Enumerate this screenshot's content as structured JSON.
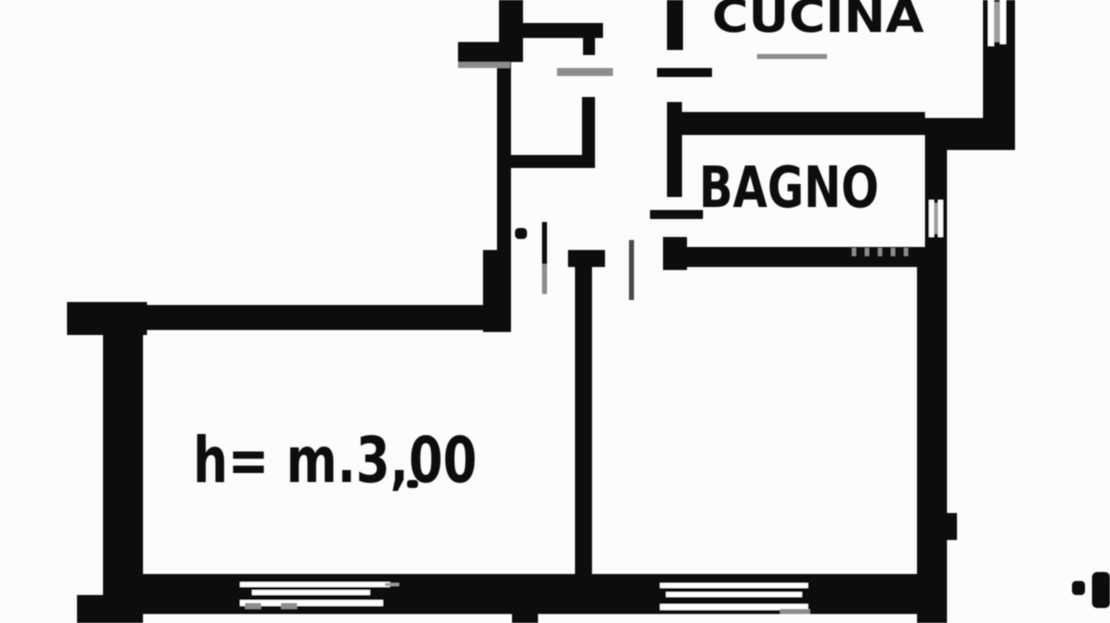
{
  "document": {
    "kind": "scanned-floor-plan",
    "paper": "#fcfcfc",
    "ink": "#0c0c0c",
    "faint": "#8c8c8c",
    "mullion": "#9c9c9c",
    "white": "#ffffff"
  },
  "labels": {
    "kitchen": "CUCINA",
    "bathroom": "BAGNO",
    "ceiling_height": "h= m.3,00"
  },
  "plan": {
    "width": 1110,
    "height": 623,
    "walls": [
      {
        "name": "hall-wall-upper",
        "x": 499,
        "y": 0,
        "w": 24,
        "h": 62
      },
      {
        "name": "hall-wall-tab",
        "x": 458,
        "y": 42,
        "w": 42,
        "h": 20
      },
      {
        "name": "hall-wall-mid",
        "x": 497,
        "y": 62,
        "w": 14,
        "h": 192
      },
      {
        "name": "hall-wall-base",
        "x": 483,
        "y": 250,
        "w": 28,
        "h": 82
      },
      {
        "name": "living-top-wall",
        "x": 67,
        "y": 305,
        "w": 430,
        "h": 25
      },
      {
        "name": "living-top-left-corner",
        "x": 67,
        "y": 302,
        "w": 80,
        "h": 33
      },
      {
        "name": "living-left-wall",
        "x": 103,
        "y": 330,
        "w": 40,
        "h": 293
      },
      {
        "name": "living-left-foot",
        "x": 77,
        "y": 595,
        "w": 66,
        "h": 28
      },
      {
        "name": "bottom-wall",
        "x": 143,
        "y": 574,
        "w": 790,
        "h": 40
      },
      {
        "name": "bottom-wall-nub",
        "x": 512,
        "y": 610,
        "w": 26,
        "h": 13
      },
      {
        "name": "partition-wall",
        "x": 575,
        "y": 252,
        "w": 17,
        "h": 330
      },
      {
        "name": "partition-cap",
        "x": 568,
        "y": 250,
        "w": 37,
        "h": 17
      },
      {
        "name": "right-wall",
        "x": 917,
        "y": 247,
        "w": 30,
        "h": 376
      },
      {
        "name": "right-wall-bump",
        "x": 947,
        "y": 513,
        "w": 10,
        "h": 27
      },
      {
        "name": "bath-right-wall",
        "x": 925,
        "y": 148,
        "w": 22,
        "h": 99
      },
      {
        "name": "setback-wall",
        "x": 925,
        "y": 118,
        "w": 90,
        "h": 32
      },
      {
        "name": "kitchen-right-wall",
        "x": 983,
        "y": 0,
        "w": 32,
        "h": 148
      },
      {
        "name": "bath-top-wall",
        "x": 678,
        "y": 112,
        "w": 247,
        "h": 23
      },
      {
        "name": "bath-left-wall",
        "x": 667,
        "y": 102,
        "w": 15,
        "h": 95
      },
      {
        "name": "kitchen-left-wall",
        "x": 667,
        "y": 0,
        "w": 16,
        "h": 50
      },
      {
        "name": "bath-bottom-wall",
        "x": 663,
        "y": 247,
        "w": 254,
        "h": 20
      },
      {
        "name": "bath-bottom-corner",
        "x": 663,
        "y": 237,
        "w": 24,
        "h": 33
      },
      {
        "name": "closet-top-wall",
        "x": 522,
        "y": 23,
        "w": 81,
        "h": 15
      },
      {
        "name": "closet-right-stub",
        "x": 583,
        "y": 38,
        "w": 12,
        "h": 17
      },
      {
        "name": "closet-right-wall",
        "x": 582,
        "y": 97,
        "w": 13,
        "h": 63
      },
      {
        "name": "closet-bottom-wall",
        "x": 505,
        "y": 155,
        "w": 90,
        "h": 13
      },
      {
        "name": "kitchen-door-sill",
        "x": 657,
        "y": 68,
        "w": 55,
        "h": 9
      },
      {
        "name": "bath-door-sill",
        "x": 650,
        "y": 210,
        "w": 53,
        "h": 9
      },
      {
        "name": "living-door-leaf-upper",
        "x": 542,
        "y": 222,
        "w": 5,
        "h": 42
      },
      {
        "name": "living-door-hinge-dot",
        "x": 515,
        "y": 228,
        "w": 12,
        "h": 11,
        "rx": 4
      },
      {
        "name": "room-dot",
        "x": 407,
        "y": 480,
        "w": 11,
        "h": 8,
        "rx": 3
      },
      {
        "name": "edge-mark-small",
        "x": 1072,
        "y": 581,
        "w": 13,
        "h": 14,
        "rx": 4
      },
      {
        "name": "edge-mark-clipped",
        "x": 1092,
        "y": 572,
        "w": 18,
        "h": 36,
        "rx": 5
      }
    ],
    "window_slits": [
      {
        "name": "kitchen-window-slit-1",
        "x": 988,
        "y": 0,
        "w": 6,
        "h": 46
      },
      {
        "name": "kitchen-window-slit-2",
        "x": 1000,
        "y": 0,
        "w": 6,
        "h": 44
      },
      {
        "name": "bath-window-slit-1",
        "x": 929,
        "y": 200,
        "w": 5,
        "h": 37
      },
      {
        "name": "bath-window-slit-2",
        "x": 938,
        "y": 200,
        "w": 5,
        "h": 37
      },
      {
        "name": "left-window-slit-1",
        "x": 240,
        "y": 582,
        "w": 150,
        "h": 5
      },
      {
        "name": "left-window-slit-2",
        "x": 252,
        "y": 590,
        "w": 118,
        "h": 5
      },
      {
        "name": "left-window-slit-3",
        "x": 240,
        "y": 600,
        "w": 143,
        "h": 6
      },
      {
        "name": "right-window-slit-1",
        "x": 660,
        "y": 583,
        "w": 148,
        "h": 5
      },
      {
        "name": "right-window-slit-2",
        "x": 666,
        "y": 592,
        "w": 136,
        "h": 5
      },
      {
        "name": "right-window-slit-3",
        "x": 660,
        "y": 604,
        "w": 148,
        "h": 6
      }
    ],
    "window_mullions": [
      {
        "name": "kitchen-window-mullion",
        "x": 994,
        "y": 2,
        "w": 6,
        "h": 40
      },
      {
        "name": "bath-window-mullion",
        "x": 934,
        "y": 203,
        "w": 4,
        "h": 31
      },
      {
        "name": "left-window-lead",
        "x": 385,
        "y": 583,
        "w": 14,
        "h": 3
      }
    ],
    "gray_marks": [
      {
        "name": "kitchen-door-leaf",
        "x": 757,
        "y": 54,
        "w": 70,
        "h": 5
      },
      {
        "name": "closet-door-leaf",
        "x": 557,
        "y": 68,
        "w": 56,
        "h": 8
      },
      {
        "name": "living-door-leaf-lower",
        "x": 542,
        "y": 264,
        "w": 5,
        "h": 30
      },
      {
        "name": "hall-door-leaf",
        "x": 629,
        "y": 240,
        "w": 5,
        "h": 60,
        "fill": "#4a4a4a"
      },
      {
        "name": "bath-rail-tick-1",
        "x": 852,
        "y": 248,
        "w": 4,
        "h": 8
      },
      {
        "name": "bath-rail-tick-2",
        "x": 865,
        "y": 248,
        "w": 4,
        "h": 8
      },
      {
        "name": "bath-rail-tick-3",
        "x": 878,
        "y": 248,
        "w": 4,
        "h": 8
      },
      {
        "name": "bath-rail-tick-4",
        "x": 891,
        "y": 248,
        "w": 4,
        "h": 8
      },
      {
        "name": "bath-rail-tick-5",
        "x": 904,
        "y": 248,
        "w": 4,
        "h": 8
      },
      {
        "name": "left-window-tick-a",
        "x": 245,
        "y": 603,
        "w": 16,
        "h": 6
      },
      {
        "name": "left-window-tick-b",
        "x": 281,
        "y": 603,
        "w": 16,
        "h": 6
      },
      {
        "name": "right-window-tick",
        "x": 780,
        "y": 609,
        "w": 30,
        "h": 5
      },
      {
        "name": "hall-tab-shadow",
        "x": 458,
        "y": 62,
        "w": 52,
        "h": 6
      }
    ]
  }
}
